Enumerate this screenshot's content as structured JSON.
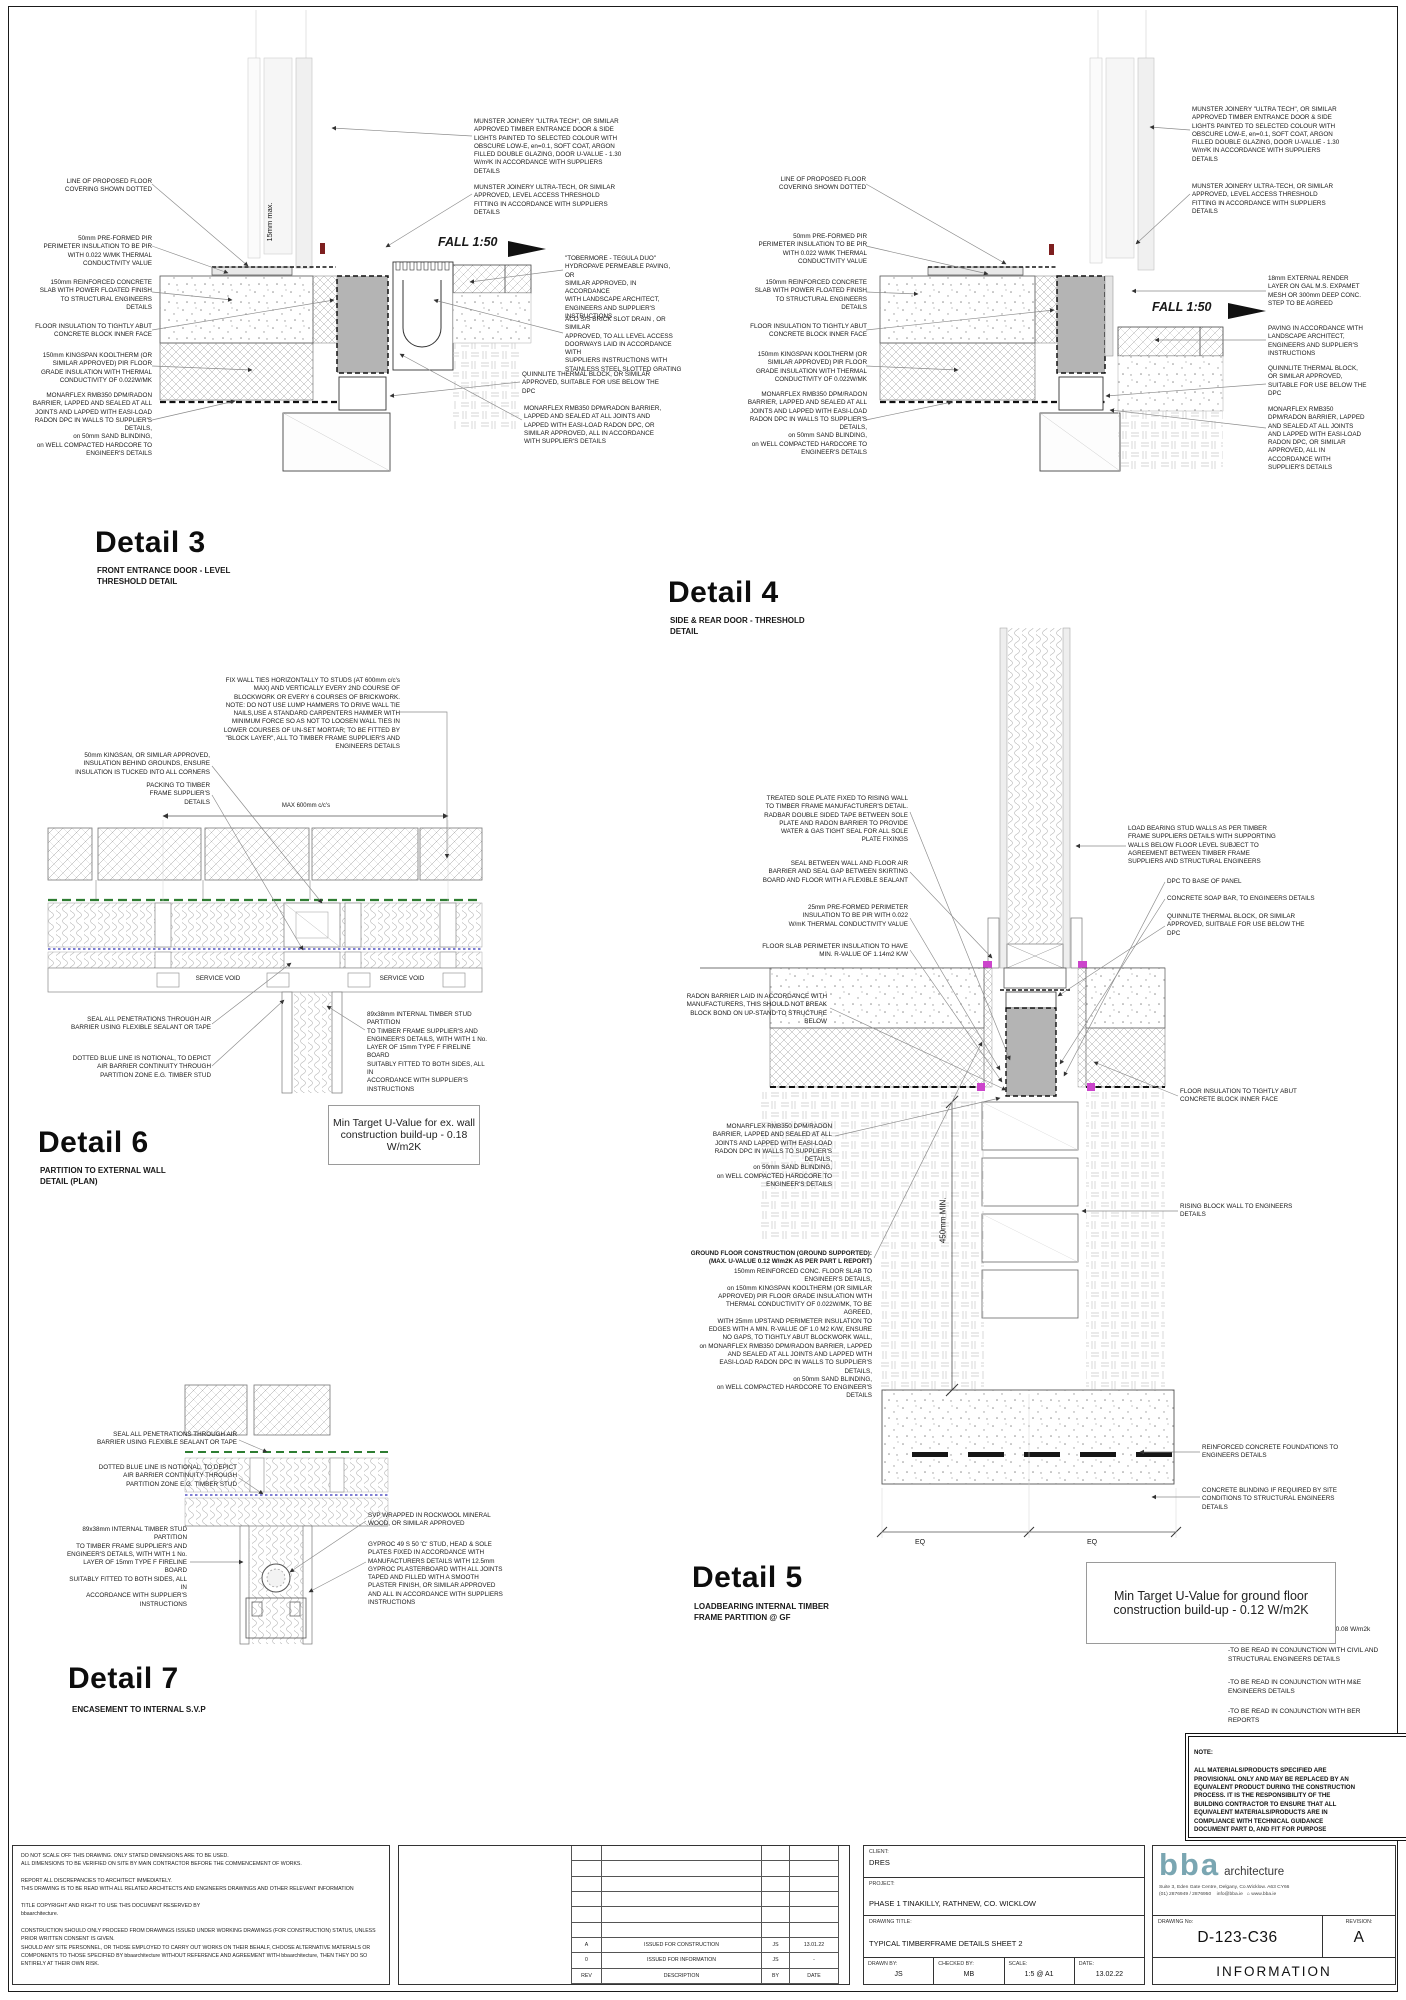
{
  "colors": {
    "grey_block": "#b4b4b4",
    "green_membrane": "#2e7d32",
    "blue_notional": "#3333bb",
    "magenta": "#cc44cc",
    "red_mark": "#7e1f1f",
    "logo_teal": "#7aa6b2"
  },
  "annotations": [
    {
      "n": "detail3-title",
      "t": "Detail 3",
      "x": 95,
      "y": 528,
      "w": 220,
      "a": "l",
      "cls": "title"
    },
    {
      "n": "detail3-subtitle",
      "t": "FRONT ENTRANCE DOOR - LEVEL\nTHRESHOLD DETAIL",
      "x": 97,
      "y": 566,
      "w": 180,
      "a": "l",
      "cls": "sub"
    },
    {
      "t": "LINE OF PROPOSED FLOOR\nCOVERING SHOWN DOTTED",
      "x": 40,
      "y": 178,
      "w": 112,
      "a": "r"
    },
    {
      "t": "50mm PRE-FORMED  PIR\nPERIMETER INSULATION TO BE PIR\nWITH 0.022 W/MK THERMAL\nCONDUCTIVITY VALUE",
      "x": 32,
      "y": 235,
      "w": 120,
      "a": "r"
    },
    {
      "t": "150mm REINFORCED CONCRETE\nSLAB WITH POWER FLOATED FINISH\nTO STRUCTURAL ENGINEERS\nDETAILS",
      "x": 28,
      "y": 279,
      "w": 124,
      "a": "r"
    },
    {
      "t": "FLOOR INSULATION TO TIGHTLY ABUT\nCONCRETE BLOCK INNER FACE",
      "x": 28,
      "y": 323,
      "w": 124,
      "a": "r"
    },
    {
      "t": "150mm KINGSPAN KOOLTHERM (OR\nSIMILAR APPROVED) PIR FLOOR\nGRADE INSULATION WITH THERMAL\nCONDUCTIVITY OF 0.022W/MK",
      "x": 24,
      "y": 352,
      "w": 128,
      "a": "r"
    },
    {
      "t": "MONARFLEX RMB350 DPM/RADON\nBARRIER, LAPPED AND SEALED AT ALL\nJOINTS AND LAPPED WITH EASI-LOAD\nRADON DPC IN WALLS TO SUPPLIER'S\nDETAILS,\non 50mm SAND BLINDING,\non WELL COMPACTED HARDCORE TO\nENGINEER'S DETAILS",
      "x": 20,
      "y": 392,
      "w": 132,
      "a": "r"
    },
    {
      "t": "MUNSTER JOINERY \"ULTRA TECH\", OR SIMILAR\nAPPROVED TIMBER ENTRANCE DOOR & SIDE\nLIGHTS PAINTED TO SELECTED COLOUR WITH\nOBSCURE LOW-E, en=0.1, SOFT COAT, ARGON\nFILLED DOUBLE GLAZING, DOOR U-VALUE - 1.30\nW/m²K IN ACCORDANCE WITH SUPPLIERS\nDETAILS",
      "x": 474,
      "y": 118,
      "w": 160,
      "a": "l"
    },
    {
      "t": "MUNSTER JOINERY ULTRA-TECH, OR SIMILAR\nAPPROVED, LEVEL ACCESS THRESHOLD\nFITTING IN ACCORDANCE WITH SUPPLIERS\nDETAILS",
      "x": 474,
      "y": 184,
      "w": 160,
      "a": "l"
    },
    {
      "t": "\"TOBERMORE - TEGULA DUO\"\nHYDROPAVE PERMEABLE PAVING, OR\nSIMILAR APPROVED, IN ACCORDANCE\nWITH LANDSCAPE ARCHITECT,\nENGINEERS AND SUPPLIER'S\nINSTRUCTIONS",
      "x": 565,
      "y": 255,
      "w": 114,
      "a": "l"
    },
    {
      "t": "ACO S/S BRICK SLOT DRAIN , OR SIMILAR\nAPPROVED, TO ALL LEVEL ACCESS\nDOORWAYS LAID IN ACCORDANCE WITH\nSUPPLIERS INSTRUCTIONS WITH\nSTAINLESS STEEL SLOTTED GRATING",
      "x": 565,
      "y": 316,
      "w": 120,
      "a": "l"
    },
    {
      "t": "QUINNLITE THERMAL BLOCK, OR SIMILAR\nAPPROVED, SUITABLE FOR USE BELOW THE\nDPC",
      "x": 522,
      "y": 371,
      "w": 142,
      "a": "l"
    },
    {
      "t": "MONARFLEX RMB350 DPM/RADON BARRIER,\nLAPPED AND SEALED AT ALL JOINTS AND\nLAPPED WITH EASI-LOAD RADON DPC, OR\nSIMILAR APPROVED, ALL IN ACCORDANCE\nWITH SUPPLIER'S DETAILS",
      "x": 524,
      "y": 405,
      "w": 148,
      "a": "l"
    },
    {
      "n": "fall-label",
      "t": "FALL 1:50",
      "x": 438,
      "y": 234,
      "w": 70,
      "a": "l",
      "size": 12.5,
      "cls": "i b"
    },
    {
      "t": "15mm max.",
      "x": 240,
      "y": 217,
      "w": 60,
      "a": "c",
      "size": 7.5,
      "cls": "rot"
    },
    {
      "n": "detail4-title",
      "t": "Detail 4",
      "x": 668,
      "y": 578,
      "w": 220,
      "a": "l",
      "cls": "title"
    },
    {
      "n": "detail4-subtitle",
      "t": "SIDE & REAR DOOR - THRESHOLD\nDETAIL",
      "x": 670,
      "y": 616,
      "w": 180,
      "a": "l",
      "cls": "sub"
    },
    {
      "t": "LINE OF PROPOSED FLOOR\nCOVERING SHOWN DOTTED",
      "x": 758,
      "y": 176,
      "w": 108,
      "a": "r"
    },
    {
      "t": "50mm PRE-FORMED  PIR\nPERIMETER INSULATION TO BE PIR\nWITH 0.022 W/MK THERMAL\nCONDUCTIVITY VALUE",
      "x": 745,
      "y": 233,
      "w": 122,
      "a": "r"
    },
    {
      "t": "150mm REINFORCED CONCRETE\nSLAB WITH POWER FLOATED FINISH\nTO STRUCTURAL ENGINEERS\nDETAILS",
      "x": 741,
      "y": 279,
      "w": 126,
      "a": "r"
    },
    {
      "t": "FLOOR INSULATION TO TIGHTLY ABUT\nCONCRETE BLOCK INNER FACE",
      "x": 741,
      "y": 323,
      "w": 126,
      "a": "r"
    },
    {
      "t": "150mm KINGSPAN KOOLTHERM (OR\nSIMILAR APPROVED) PIR FLOOR\nGRADE INSULATION WITH THERMAL\nCONDUCTIVITY OF 0.022W/MK",
      "x": 737,
      "y": 351,
      "w": 130,
      "a": "r"
    },
    {
      "t": "MONARFLEX RMB350 DPM/RADON\nBARRIER, LAPPED AND SEALED AT ALL\nJOINTS AND LAPPED WITH EASI-LOAD\nRADON DPC IN WALLS TO SUPPLIER'S\nDETAILS,\non 50mm SAND BLINDING,\non WELL COMPACTED HARDCORE TO\nENGINEER'S DETAILS",
      "x": 733,
      "y": 391,
      "w": 134,
      "a": "r"
    },
    {
      "t": "MUNSTER JOINERY \"ULTRA TECH\", OR SIMILAR\nAPPROVED TIMBER ENTRANCE DOOR & SIDE\nLIGHTS PAINTED TO SELECTED COLOUR WITH\nOBSCURE LOW-E, en=0.1, SOFT COAT, ARGON\nFILLED DOUBLE GLAZING, DOOR U-VALUE - 1.30\nW/m²K IN ACCORDANCE WITH SUPPLIERS\nDETAILS",
      "x": 1192,
      "y": 106,
      "w": 162,
      "a": "l"
    },
    {
      "t": "MUNSTER JOINERY ULTRA-TECH, OR SIMILAR\nAPPROVED, LEVEL ACCESS THRESHOLD\nFITTING IN ACCORDANCE WITH SUPPLIERS\nDETAILS",
      "x": 1192,
      "y": 183,
      "w": 162,
      "a": "l"
    },
    {
      "t": "18mm EXTERNAL RENDER\nLAYER ON GAL M.S. EXPAMET\nMESH OR 300mm DEEP CONC.\nSTEP TO BE AGREED",
      "x": 1268,
      "y": 275,
      "w": 96,
      "a": "l"
    },
    {
      "t": "PAVING IN ACCORDANCE WITH\nLANDSCAPE ARCHITECT,\nENGINEERS AND SUPPLIER'S\nINSTRUCTIONS",
      "x": 1268,
      "y": 325,
      "w": 100,
      "a": "l"
    },
    {
      "t": "QUINNLITE THERMAL BLOCK,\nOR SIMILAR APPROVED,\nSUITABLE FOR USE BELOW THE\nDPC",
      "x": 1268,
      "y": 365,
      "w": 100,
      "a": "l"
    },
    {
      "t": "MONARFLEX RMB350\nDPM/RADON BARRIER, LAPPED\nAND SEALED AT ALL JOINTS\nAND LAPPED WITH EASI-LOAD\nRADON DPC, OR SIMILAR\nAPPROVED, ALL IN\nACCORDANCE WITH\nSUPPLIER'S DETAILS",
      "x": 1268,
      "y": 406,
      "w": 100,
      "a": "l"
    },
    {
      "n": "fall-label",
      "t": "FALL 1:50",
      "x": 1152,
      "y": 299,
      "w": 70,
      "a": "l",
      "size": 12.5,
      "cls": "i b"
    },
    {
      "n": "detail6-title",
      "t": "Detail 6",
      "x": 38,
      "y": 1128,
      "w": 220,
      "a": "l",
      "cls": "title"
    },
    {
      "n": "detail6-subtitle",
      "t": "PARTITION TO EXTERNAL WALL\nDETAIL (PLAN)",
      "x": 40,
      "y": 1166,
      "w": 170,
      "a": "l",
      "cls": "sub"
    },
    {
      "t": "FIX WALL TIES HORIZONTALLY TO STUDS (AT 600mm c/c's\nMAX) AND VERTICALLY EVERY 2ND COURSE OF\nBLOCKWORK OR EVERY 6 COURSES OF BRICKWORK.\nNOTE: DO NOT USE LUMP HAMMERS TO DRIVE WALL TIE\nNAILS,USE A STANDARD CARPENTERS HAMMER WITH\nMINIMUM FORCE SO AS NOT TO LOOSEN WALL TIES IN\nLOWER COURSES OF UN-SET MORTAR; TO BE FITTED BY\n\"BLOCK LAYER\", ALL TO TIMBER FRAME SUPPLIER'S AND\nENGINEERS DETAILS",
      "x": 205,
      "y": 677,
      "w": 195,
      "a": "r"
    },
    {
      "t": "50mm KINGSAN, OR SIMILAR APPROVED,\nINSULATION BEHIND GROUNDS, ENSURE\nINSULATION IS TUCKED INTO ALL CORNERS",
      "x": 62,
      "y": 752,
      "w": 148,
      "a": "r"
    },
    {
      "t": "PACKING TO TIMBER\nFRAME SUPPLIER'S\nDETAILS",
      "x": 110,
      "y": 782,
      "w": 100,
      "a": "r"
    },
    {
      "t": "MAX 600mm c/c's",
      "x": 248,
      "y": 803,
      "w": 116,
      "a": "c",
      "size": 6
    },
    {
      "t": "SERVICE VOID",
      "x": 188,
      "y": 975,
      "w": 60,
      "a": "c"
    },
    {
      "t": "SERVICE VOID",
      "x": 372,
      "y": 975,
      "w": 60,
      "a": "c"
    },
    {
      "t": "SEAL ALL PENETRATIONS THROUGH AIR\nBARRIER USING FLEXIBLE SEALANT OR TAPE",
      "x": 56,
      "y": 1016,
      "w": 155,
      "a": "r"
    },
    {
      "t": "DOTTED BLUE LINE IS NOTIONAL, TO DEPICT\nAIR BARRIER CONTINUITY THROUGH\nPARTITION ZONE E.G. TIMBER STUD",
      "x": 62,
      "y": 1055,
      "w": 149,
      "a": "r"
    },
    {
      "t": "89x38mm INTERNAL TIMBER STUD PARTITION\nTO TIMBER FRAME SUPPLIER'S AND\nENGINEER'S DETAILS, WITH WITH 1 No.\nLAYER OF 15mm TYPE F FIRELINE BOARD\nSUITABLY FITTED TO BOTH SIDES, ALL IN\nACCORDANCE WITH SUPPLIER'S\nINSTRUCTIONS",
      "x": 367,
      "y": 1011,
      "w": 122,
      "a": "l"
    },
    {
      "n": "detail5-title",
      "t": "Detail 5",
      "x": 692,
      "y": 1563,
      "w": 220,
      "a": "l",
      "cls": "title"
    },
    {
      "n": "detail5-subtitle",
      "t": "LOADBEARING INTERNAL TIMBER\nFRAME PARTITION @ GF",
      "x": 694,
      "y": 1602,
      "w": 180,
      "a": "l",
      "cls": "sub"
    },
    {
      "t": "TREATED SOLE PLATE FIXED TO RISING WALL\nTO TIMBER FRAME MANUFACTURER'S DETAIL.\nRADBAR DOUBLE SIDED TAPE BETWEEN SOLE\nPLATE AND RADON BARRIER TO PROVIDE\nWATER & GAS TIGHT SEAL FOR ALL SOLE\nPLATE FIXINGS",
      "x": 743,
      "y": 795,
      "w": 165,
      "a": "r"
    },
    {
      "t": "SEAL BETWEEN WALL AND FLOOR AIR\nBARRIER AND SEAL GAP BETWEEN SKIRTING\nBOARD AND FLOOR WITH A FLEXIBLE SEALANT",
      "x": 740,
      "y": 860,
      "w": 168,
      "a": "r"
    },
    {
      "t": "25mm PRE-FORMED PERIMETER\nINSULATION TO BE PIR WITH 0.022\nW/mK THERMAL CONDUCTIVITY VALUE",
      "x": 745,
      "y": 904,
      "w": 163,
      "a": "r"
    },
    {
      "t": "FLOOR SLAB PERIMETER INSULATION TO HAVE\nMIN. R-VALUE OF 1.14m2 K/W",
      "x": 745,
      "y": 943,
      "w": 163,
      "a": "r"
    },
    {
      "t": "RADON BARRIER LAID IN ACCORDANCE WITH\nMANUFACTURERS, THIS SHOULD NOT BREAK\nBLOCK BOND ON UP-STAND TO STRUCTURE\nBELOW",
      "x": 672,
      "y": 993,
      "w": 155,
      "a": "r"
    },
    {
      "t": "MONARFLEX RMB350 DPM/RADON\nBARRIER, LAPPED AND SEALED AT ALL\nJOINTS AND LAPPED WITH EASI-LOAD\nRADON DPC IN WALLS TO SUPPLIER'S\nDETAILS,\non 50mm SAND BLINDING,\non WELL COMPACTED HARDCORE TO\nENGINEER'S DETAILS",
      "x": 695,
      "y": 1123,
      "w": 137,
      "a": "r"
    },
    {
      "t": "GROUND FLOOR CONSTRUCTION (GROUND SUPPORTED):\n(MAX. U-VALUE 0.12 W/m2K AS PER PART L REPORT)",
      "x": 680,
      "y": 1250,
      "w": 192,
      "a": "r",
      "cls": "b"
    },
    {
      "t": "150mm REINFORCED CONC. FLOOR SLAB TO\nENGINEER'S DETAILS,\non 150mm KINGSPAN KOOLTHERM (OR SIMILAR\nAPPROVED) PIR FLOOR GRADE INSULATION WITH\nTHERMAL CONDUCTIVITY OF 0.022W/MK, TO BE\nAGREED,\nWITH 25mm UPSTAND PERIMETER INSULATION TO\nEDGES WITH A MIN. R-VALUE OF 1.0 M2 K/W, ENSURE\nNO GAPS, TO TIGHTLY ABUT BLOCKWORK WALL,\non MONARFLEX RMB350 DPM/RADON BARRIER, LAPPED\nAND SEALED AT ALL JOINTS AND LAPPED WITH\nEASI-LOAD RADON DPC IN WALLS TO SUPPLIER'S\nDETAILS,\non 50mm SAND BLINDING,\non WELL COMPACTED HARDCORE TO ENGINEER'S\nDETAILS",
      "x": 680,
      "y": 1268,
      "w": 192,
      "a": "r"
    },
    {
      "t": "LOAD BEARING STUD WALLS AS PER TIMBER\nFRAME SUPPLIERS DETAILS WITH SUPPORTING\nWALLS BELOW FLOOR LEVEL SUBJECT TO\nAGREEMENT BETWEEN TIMBER FRAME\nSUPPLIERS AND STRUCTURAL ENGINEERS",
      "x": 1128,
      "y": 825,
      "w": 152,
      "a": "l"
    },
    {
      "t": "DPC TO BASE OF PANEL",
      "x": 1167,
      "y": 878,
      "w": 110,
      "a": "l"
    },
    {
      "t": "CONCRETE SOAP BAR, TO ENGINEERS DETAILS",
      "x": 1167,
      "y": 895,
      "w": 165,
      "a": "l"
    },
    {
      "t": "QUINNLITE THERMAL BLOCK, OR SIMILAR\nAPPROVED, SUITBALE FOR USE BELOW THE\nDPC",
      "x": 1167,
      "y": 913,
      "w": 150,
      "a": "l"
    },
    {
      "t": "FLOOR INSULATION TO TIGHTLY ABUT\nCONCRETE BLOCK INNER FACE",
      "x": 1180,
      "y": 1088,
      "w": 145,
      "a": "l"
    },
    {
      "t": "RISING BLOCK WALL TO ENGINEERS\nDETAILS",
      "x": 1180,
      "y": 1203,
      "w": 125,
      "a": "l"
    },
    {
      "t": "REINFORCED CONCRETE FOUNDATIONS TO\nENGINEERS DETAILS",
      "x": 1202,
      "y": 1444,
      "w": 155,
      "a": "l"
    },
    {
      "t": "CONCRETE BLINDING IF REQUIRED BY SITE\nCONDITIONS TO STRUCTURAL ENGINEERS\nDETAILS",
      "x": 1202,
      "y": 1487,
      "w": 162,
      "a": "l"
    },
    {
      "t": "EQ",
      "x": 890,
      "y": 1538,
      "w": 60,
      "a": "c",
      "size": 7
    },
    {
      "t": "EQ",
      "x": 1062,
      "y": 1538,
      "w": 60,
      "a": "c",
      "size": 7
    },
    {
      "t": "450mm MIN.",
      "x": 904,
      "y": 1215,
      "w": 80,
      "a": "c",
      "size": 8,
      "cls": "rot"
    },
    {
      "t": "-THERMAL BRIDGING FACTOR:      0.08 W/m2k",
      "x": 1228,
      "y": 1626,
      "w": 175,
      "a": "l",
      "size": 6.5
    },
    {
      "t": "-TO BE READ IN CONJUNCTION WITH CIVIL AND\nSTRUCTURAL ENGINEERS DETAILS",
      "x": 1228,
      "y": 1647,
      "w": 172,
      "a": "l",
      "size": 6.5
    },
    {
      "t": "-TO BE READ IN CONJUNCTION WITH M&E\nENGINEERS DETAILS",
      "x": 1228,
      "y": 1679,
      "w": 172,
      "a": "l",
      "size": 6.5
    },
    {
      "t": "-TO BE READ IN CONJUNCTION WITH BER\nREPORTS",
      "x": 1228,
      "y": 1708,
      "w": 172,
      "a": "l",
      "size": 6.5
    },
    {
      "n": "detail7-title",
      "t": "Detail 7",
      "x": 68,
      "y": 1664,
      "w": 220,
      "a": "l",
      "cls": "title"
    },
    {
      "n": "detail7-subtitle",
      "t": "ENCASEMENT TO INTERNAL S.V.P",
      "x": 72,
      "y": 1705,
      "w": 180,
      "a": "l",
      "cls": "sub"
    },
    {
      "t": "SEAL ALL PENETRATIONS THROUGH AIR\nBARRIER USING FLEXIBLE SEALANT OR TAPE",
      "x": 85,
      "y": 1431,
      "w": 152,
      "a": "r"
    },
    {
      "t": "DOTTED BLUE LINE IS NOTIONAL, TO DEPICT\nAIR BARRIER CONTINUITY THROUGH\nPARTITION ZONE E.G. TIMBER STUD",
      "x": 85,
      "y": 1464,
      "w": 152,
      "a": "r"
    },
    {
      "t": "89x38mm INTERNAL TIMBER STUD PARTITION\nTO TIMBER FRAME SUPPLIER'S AND\nENGINEER'S DETAILS, WITH WITH 1 No.\nLAYER OF 15mm TYPE F FIRELINE BOARD\nSUITABLY FITTED TO BOTH SIDES, ALL IN\nACCORDANCE WITH SUPPLIER'S\nINSTRUCTIONS",
      "x": 62,
      "y": 1526,
      "w": 125,
      "a": "r"
    },
    {
      "t": "SVP WRAPPED IN ROCKWOOL MINERAL\nWOOD, OR SIMILAR APPROVED",
      "x": 368,
      "y": 1512,
      "w": 138,
      "a": "l"
    },
    {
      "t": "GYPROC 49 S 50 'C' STUD, HEAD & SOLE\nPLATES FIXED IN ACCORDANCE WITH\nMANUFACTURERS DETAILS WITH 12.5mm\nGYPROC PLASTERBOARD WITH ALL JOINTS\nTAPED AND FILLED WITH A SMOOTH\nPLASTER FINISH, OR SIMILAR APPROVED\nAND ALL IN ACCORDANCE WITH SUPPLIERS\nINSTRUCTIONS",
      "x": 368,
      "y": 1541,
      "w": 142,
      "a": "l"
    }
  ],
  "uboxes": [
    {
      "text": "Min Target U-Value for ex. wall\nconstruction build-up - 0.18 W/m2K",
      "x": 328,
      "y": 1105,
      "w": 150,
      "h": 58,
      "size": 10.5
    },
    {
      "text": "Min Target U-Value for ground floor\nconstruction build-up - 0.12 W/m2K",
      "x": 1086,
      "y": 1562,
      "w": 248,
      "h": 80,
      "size": 12.5
    }
  ],
  "note_box": {
    "x": 1185,
    "y": 1733,
    "w": 213,
    "h": 92,
    "title": "NOTE:",
    "text": "ALL MATERIALS/PRODUCTS SPECIFIED ARE\nPROVISIONAL ONLY AND MAY BE REPLACED BY AN\nEQUIVALENT PRODUCT DURING THE CONSTRUCTION\nPROCESS. IT IS THE RESPONSIBILITY OF THE\nBUILDING CONTRACTOR TO ENSURE THAT ALL\nEQUIVALENT MATERIALS/PRODUCTS ARE IN\nCOMPLIANCE WITH TECHNICAL GUIDANCE\nDOCUMENT PART D, AND FIT FOR PURPOSE"
  },
  "titleblock": {
    "disclaimers": [
      "DO NOT SCALE OFF THIS DRAWING. ONLY STATED DIMENSIONS ARE TO BE USED.\nALL DIMENSIONS TO BE VERIFIED ON SITE BY MAIN CONTRACTOR BEFORE THE COMMENCEMENT OF WORKS.",
      "REPORT ALL DISCREPANCIES TO ARCHITECT IMMEDIATELY.\nTHIS DRAWING IS TO BE READ WITH ALL RELATED ARCHITECTS AND ENGINEERS  DRAWINGS AND OTHER RELEVANT INFORMATION",
      "TITLE COPYRIGHT AND RIGHT TO USE THIS DOCUMENT RESERVED BY\nbbaarchitecture.",
      "CONSTRUCTION SHOULD ONLY PROCEED FROM DRAWINGS ISSUED UNDER WORKING DRAWINGS (FOR CONSTRUCTION) STATUS, UNLESS PRIOR WRITTEN CONSENT IS GIVEN.\nSHOULD ANY SITE PERSONNEL, OR THOSE EMPLOYED TO CARRY OUT WORKS ON THEIR BEHALF, CHOOSE ALTERNATIVE MATERIALS OR COMPONENTS TO THOSE SPECIFIED BY bbaarchitecture WITHOUT REFERENCE AND AGREEMENT WITH bbaarchitecture, THEN THEY DO SO ENTIRELY AT THEIR OWN RISK."
    ],
    "issue": {
      "empty_rows": 6,
      "rows": [
        [
          "A",
          "ISSUED FOR CONSTRUCTION",
          "JS",
          "13.01.22"
        ],
        [
          "0",
          "ISSUED FOR INFORMATION",
          "JS",
          "-"
        ],
        [
          "REV",
          "DESCRIPTION",
          "BY",
          "DATE"
        ]
      ]
    },
    "client_label": "CLIENT:",
    "client": "DRES",
    "project_label": "PROJECT:",
    "project": "PHASE 1 TINAKILLY, RATHNEW, CO. WICKLOW",
    "drawing_title_label": "DRAWING TITLE:",
    "drawing_title": "TYPICAL TIMBERFRAME DETAILS SHEET 2",
    "drawn_label": "DRAWN BY:",
    "drawn": "JS",
    "checked_label": "CHECKED BY:",
    "checked": "MB",
    "scale_label": "SCALE:",
    "scale": "1:5 @ A1",
    "date_label": "DATE:",
    "date": "13.02.22",
    "drawing_no_label": "DRAWING No:",
    "drawing_no": "D-123-C36",
    "revision_label": "REVISION:",
    "revision": "A",
    "status": "INFORMATION",
    "brand": {
      "logo": "bba",
      "name": "architecture",
      "address": "Suite 3, Eden Gate Centre, Delgany, Co.Wicklow. A63 CY66",
      "phone": "(01) 2876949 / 2876950",
      "email": "info@bba.ie",
      "web": "⌂ www.bba.ie"
    }
  }
}
